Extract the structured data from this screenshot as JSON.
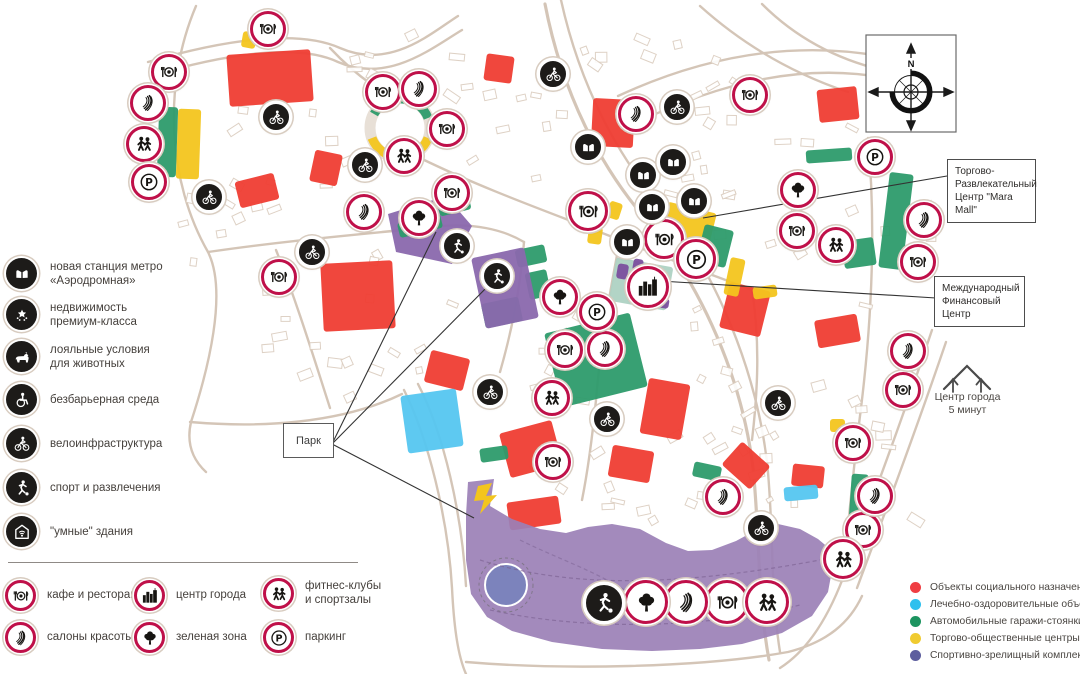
{
  "colors": {
    "ring": "#bf1049",
    "red": "#ef3d33",
    "cyan": "#55c6f0",
    "green": "#2d9b6b",
    "pale_green": "#aed2c3",
    "yellow": "#f3c51d",
    "purple": "#8a68ad",
    "purple_dark": "#7b4f9e",
    "park": "#9b80b6",
    "pond": "#7c83bc",
    "dot_red": "#ef3d42",
    "dot_cyan": "#2ec0ee",
    "dot_green": "#1d9460",
    "dot_yellow": "#f0cb30",
    "dot_slate": "#5d5e9e"
  },
  "compass_n": "N",
  "park_label": "Парк",
  "center5_label": "Центр города\n5 минут",
  "callouts": {
    "mara": "Торгово-\nРазвлекательный\nЦентр \"Mara Mall\"",
    "mfc": "Международный\nФинансовый\nЦентр"
  },
  "features_legend": [
    {
      "icon": "metro",
      "label": "новая станция метро\n«Аэродромная»"
    },
    {
      "icon": "stars",
      "label": "недвижимость\nпремиум-класса"
    },
    {
      "icon": "pet",
      "label": "лояльные условия\nдля животных"
    },
    {
      "icon": "wheelchair",
      "label": "безбарьерная среда"
    },
    {
      "icon": "bike",
      "label": "велоинфраструктура"
    },
    {
      "icon": "sport",
      "label": "спорт и развлечения"
    },
    {
      "icon": "smart",
      "label": "\"умные\" здания"
    }
  ],
  "amenity_legend": [
    {
      "icon": "rest",
      "label": "кафе и рестораны"
    },
    {
      "icon": "beauty",
      "label": "салоны красоты"
    },
    {
      "icon": "city",
      "label": "центр города"
    },
    {
      "icon": "tree",
      "label": "зеленая зона"
    },
    {
      "icon": "fitness",
      "label": "фитнес-клубы\nи спортзалы"
    },
    {
      "icon": "parking",
      "label": "паркинг"
    }
  ],
  "zones_legend": [
    {
      "color": "#ef3d42",
      "label": "Объекты социального назначения"
    },
    {
      "color": "#2ec0ee",
      "label": "Лечебно-оздоровительные объекты"
    },
    {
      "color": "#1d9460",
      "label": "Автомобильные гаражи-стоянки"
    },
    {
      "color": "#f0cb30",
      "label": "Торгово-общественные центры"
    },
    {
      "color": "#5d5e9e",
      "label": "Спортивно-зрелищный комплекс"
    }
  ],
  "map": {
    "markers": [
      {
        "t": "rest",
        "x": 268,
        "y": 29
      },
      {
        "t": "rest",
        "x": 169,
        "y": 72
      },
      {
        "t": "rest",
        "x": 383,
        "y": 92
      },
      {
        "t": "rest",
        "x": 447,
        "y": 129
      },
      {
        "t": "rest",
        "x": 452,
        "y": 193
      },
      {
        "t": "rest",
        "x": 279,
        "y": 277
      },
      {
        "t": "rest",
        "x": 588,
        "y": 211,
        "s": 40
      },
      {
        "t": "rest",
        "x": 664,
        "y": 239,
        "s": 40
      },
      {
        "t": "rest",
        "x": 750,
        "y": 95
      },
      {
        "t": "rest",
        "x": 565,
        "y": 350
      },
      {
        "t": "rest",
        "x": 797,
        "y": 231
      },
      {
        "t": "rest",
        "x": 918,
        "y": 262
      },
      {
        "t": "rest",
        "x": 903,
        "y": 390
      },
      {
        "t": "rest",
        "x": 853,
        "y": 443
      },
      {
        "t": "rest",
        "x": 863,
        "y": 530
      },
      {
        "t": "rest",
        "x": 553,
        "y": 462
      },
      {
        "t": "rest",
        "x": 727,
        "y": 602,
        "s": 44
      },
      {
        "t": "beauty",
        "x": 148,
        "y": 103
      },
      {
        "t": "beauty",
        "x": 419,
        "y": 89
      },
      {
        "t": "beauty",
        "x": 364,
        "y": 212
      },
      {
        "t": "beauty",
        "x": 636,
        "y": 114
      },
      {
        "t": "beauty",
        "x": 605,
        "y": 349
      },
      {
        "t": "beauty",
        "x": 924,
        "y": 220
      },
      {
        "t": "beauty",
        "x": 908,
        "y": 351
      },
      {
        "t": "beauty",
        "x": 875,
        "y": 496
      },
      {
        "t": "beauty",
        "x": 723,
        "y": 497
      },
      {
        "t": "beauty",
        "x": 686,
        "y": 602,
        "s": 44
      },
      {
        "t": "fitness",
        "x": 144,
        "y": 144
      },
      {
        "t": "fitness",
        "x": 404,
        "y": 156
      },
      {
        "t": "fitness",
        "x": 552,
        "y": 398
      },
      {
        "t": "fitness",
        "x": 836,
        "y": 245
      },
      {
        "t": "fitness",
        "x": 843,
        "y": 559,
        "s": 40
      },
      {
        "t": "fitness",
        "x": 767,
        "y": 602,
        "s": 44
      },
      {
        "t": "parking",
        "x": 149,
        "y": 182
      },
      {
        "t": "parking",
        "x": 875,
        "y": 157
      },
      {
        "t": "parking",
        "x": 696,
        "y": 259,
        "s": 40
      },
      {
        "t": "parking",
        "x": 597,
        "y": 312
      },
      {
        "t": "tree",
        "x": 419,
        "y": 218
      },
      {
        "t": "tree",
        "x": 560,
        "y": 297
      },
      {
        "t": "tree",
        "x": 798,
        "y": 190
      },
      {
        "t": "tree",
        "x": 646,
        "y": 602,
        "s": 44
      },
      {
        "t": "city",
        "x": 648,
        "y": 287,
        "s": 42
      },
      {
        "t": "metro",
        "x": 588,
        "y": 147,
        "f": 1
      },
      {
        "t": "metro",
        "x": 643,
        "y": 175,
        "f": 1
      },
      {
        "t": "metro",
        "x": 673,
        "y": 162,
        "f": 1
      },
      {
        "t": "metro",
        "x": 652,
        "y": 207,
        "f": 1
      },
      {
        "t": "metro",
        "x": 694,
        "y": 201,
        "f": 1
      },
      {
        "t": "metro",
        "x": 627,
        "y": 242,
        "f": 1
      },
      {
        "t": "bike",
        "x": 276,
        "y": 117,
        "f": 1
      },
      {
        "t": "bike",
        "x": 209,
        "y": 197,
        "f": 1
      },
      {
        "t": "bike",
        "x": 365,
        "y": 165,
        "f": 1
      },
      {
        "t": "bike",
        "x": 553,
        "y": 74,
        "f": 1
      },
      {
        "t": "bike",
        "x": 677,
        "y": 107,
        "f": 1
      },
      {
        "t": "bike",
        "x": 312,
        "y": 252,
        "f": 1
      },
      {
        "t": "bike",
        "x": 490,
        "y": 392,
        "f": 1
      },
      {
        "t": "bike",
        "x": 607,
        "y": 419,
        "f": 1
      },
      {
        "t": "bike",
        "x": 778,
        "y": 403,
        "f": 1
      },
      {
        "t": "bike",
        "x": 761,
        "y": 528,
        "f": 1
      },
      {
        "t": "sport",
        "x": 457,
        "y": 246,
        "f": 1
      },
      {
        "t": "sport",
        "x": 497,
        "y": 276,
        "f": 1
      },
      {
        "t": "sport",
        "x": 604,
        "y": 603,
        "f": 1,
        "s": 40
      }
    ],
    "blocks": [
      [
        "red",
        228,
        52,
        84,
        52,
        -4
      ],
      [
        "red",
        485,
        55,
        28,
        27,
        8
      ],
      [
        "red",
        592,
        99,
        42,
        48,
        3
      ],
      [
        "red",
        818,
        88,
        40,
        33,
        -6
      ],
      [
        "red",
        237,
        177,
        40,
        27,
        -14
      ],
      [
        "red",
        312,
        152,
        28,
        32,
        12
      ],
      [
        "red",
        322,
        262,
        72,
        68,
        -3
      ],
      [
        "red",
        427,
        354,
        40,
        33,
        14
      ],
      [
        "red",
        504,
        426,
        54,
        46,
        -15
      ],
      [
        "red",
        610,
        448,
        42,
        32,
        10
      ],
      [
        "red",
        727,
        450,
        38,
        31,
        42
      ],
      [
        "red",
        792,
        465,
        32,
        22,
        6
      ],
      [
        "red",
        508,
        499,
        52,
        28,
        -8
      ],
      [
        "red",
        724,
        286,
        42,
        47,
        14
      ],
      [
        "red",
        816,
        317,
        43,
        28,
        -10
      ],
      [
        "red",
        644,
        381,
        42,
        56,
        10
      ],
      [
        "cyan",
        404,
        392,
        56,
        58,
        -8
      ],
      [
        "cyan",
        784,
        486,
        34,
        14,
        -5
      ],
      [
        "yellow",
        177,
        109,
        23,
        70,
        2
      ],
      [
        "yellow",
        242,
        32,
        14,
        16,
        10
      ],
      [
        "yellow",
        662,
        207,
        50,
        46,
        14
      ],
      [
        "yellow",
        727,
        258,
        15,
        38,
        12
      ],
      [
        "yellow",
        753,
        286,
        24,
        12,
        -8
      ],
      [
        "yellow",
        830,
        419,
        15,
        13,
        0
      ],
      [
        "yellow",
        608,
        202,
        13,
        17,
        18
      ],
      [
        "yellow",
        588,
        227,
        14,
        17,
        8
      ],
      [
        "green",
        158,
        107,
        19,
        70,
        2
      ],
      [
        "green",
        438,
        196,
        32,
        17,
        -14
      ],
      [
        "green",
        398,
        218,
        44,
        15,
        -14
      ],
      [
        "green",
        516,
        247,
        30,
        18,
        -12
      ],
      [
        "green",
        527,
        271,
        22,
        27,
        -12
      ],
      [
        "green",
        483,
        300,
        38,
        25,
        -12
      ],
      [
        "green",
        552,
        322,
        88,
        76,
        -14
      ],
      [
        "green",
        700,
        227,
        30,
        38,
        14
      ],
      [
        "green",
        806,
        149,
        46,
        13,
        -4
      ],
      [
        "green",
        884,
        173,
        24,
        96,
        7
      ],
      [
        "green",
        843,
        239,
        32,
        28,
        -8
      ],
      [
        "green",
        849,
        474,
        17,
        82,
        4
      ],
      [
        "green",
        480,
        447,
        28,
        14,
        -8
      ],
      [
        "green",
        693,
        464,
        28,
        15,
        12
      ],
      [
        "pale_green",
        612,
        262,
        58,
        44,
        10
      ],
      [
        "purple_dark",
        617,
        264,
        11,
        15,
        10
      ],
      [
        "purple_dark",
        633,
        259,
        10,
        12,
        10
      ],
      [
        "purple_dark",
        656,
        298,
        13,
        10,
        10
      ],
      [
        "purple",
        478,
        252,
        54,
        72,
        -12
      ]
    ],
    "polygons": {
      "purple1": "388,214 446,196 472,226 452,264 396,252",
      "park": "468,482 494,479 490,506 512,519 540,529 566,533 588,527 612,524 640,529 666,543 688,551 712,550 736,541 760,528 778,524 800,529 818,539 830,549 833,565 828,592 812,616 782,633 742,644 700,649 652,651 602,649 552,642 512,631 487,617 471,594 466,560 466,515",
      "lightning": "478,486 492,483 486,496 497,495 480,514 484,500 474,501"
    },
    "pond": {
      "cx": 506,
      "cy": 585,
      "r": 21
    },
    "lines": [
      [
        332,
        444,
        436,
        232
      ],
      [
        332,
        444,
        494,
        280
      ],
      [
        332,
        444,
        474,
        518
      ],
      [
        947,
        176,
        703,
        218
      ],
      [
        936,
        298,
        660,
        281
      ]
    ]
  }
}
